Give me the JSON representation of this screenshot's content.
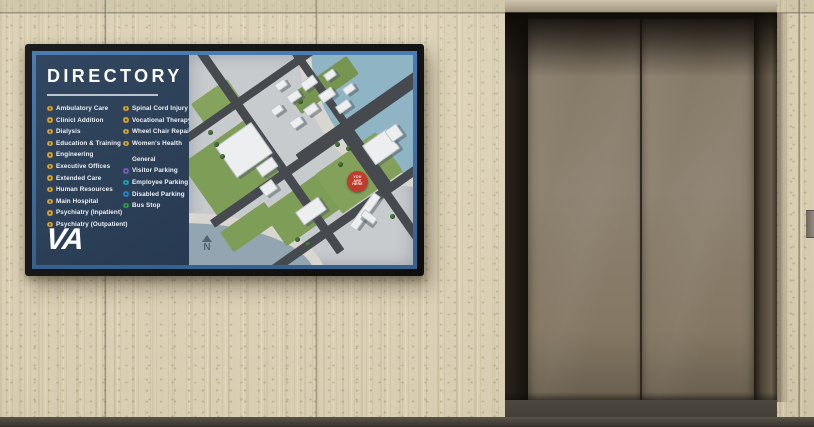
{
  "colors": {
    "navy": "#2B3F58",
    "signblue": "#3E6EA9",
    "bezel": "#141414",
    "gold": "#D9A83C",
    "purple": "#7565C6",
    "teal": "#18A9C6",
    "blue": "#2189D2",
    "green": "#2FA04E",
    "red": "#BF3B2D",
    "wall_beige": "#D9CEB2",
    "elevator_door_bronze": "#877B69",
    "floor_dark": "#3A352E",
    "map_ground": "#C7CBCE",
    "map_water": "#8FB4C4",
    "map_green": "#7E9D57",
    "map_road": "#46494D"
  },
  "sign": {
    "title": "DIRECTORY",
    "logo_text": "VA",
    "legend_left": [
      "Ambulatory Care",
      "Clinicl Addition",
      "Dialysis",
      "Education & Training",
      "Engineering",
      "Executive Offices",
      "Extended Care",
      "Human Resources",
      "Main Hospital",
      "Psychiatry (Inpatient)",
      "Psychiatry (Outpatient)"
    ],
    "legend_right": [
      "Spinal Cord Injury",
      "Vocational Therapy",
      "Wheel Chair Repair",
      "Women's Health"
    ],
    "general": {
      "header": "General",
      "items": [
        {
          "label": "Visitor Parking",
          "color": "purple"
        },
        {
          "label": "Employee Parking",
          "color": "teal"
        },
        {
          "label": "Disabled Parking",
          "color": "blue"
        },
        {
          "label": "Bus Stop",
          "color": "green"
        }
      ]
    },
    "map": {
      "you_are_here_lines": [
        "YOU",
        "ARE",
        "HERE"
      ],
      "compass_label": "N"
    }
  }
}
